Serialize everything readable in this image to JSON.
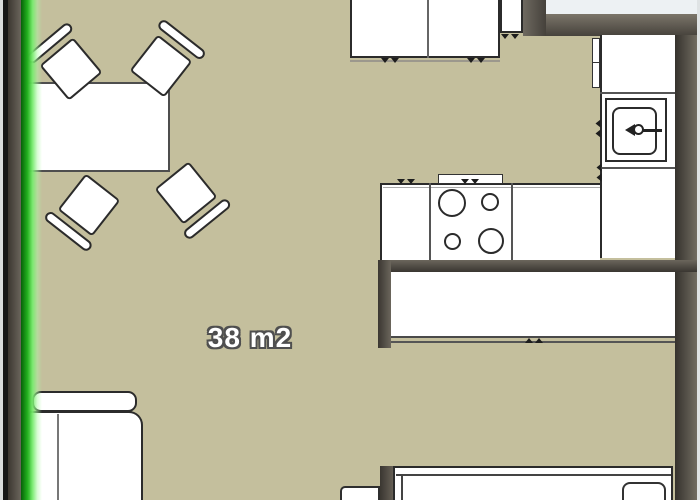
{
  "room": {
    "area_label": "38 m2"
  },
  "colors": {
    "floor": "#c4bf9d",
    "wall_dark": "#3a3631",
    "wall_light": "#7b7569",
    "exterior": "#edf1f3",
    "furniture_fill": "#ffffff",
    "furniture_outline": "#2b2b2b",
    "highlight_green": "#3ecf38",
    "label_text": "#ffffff",
    "label_outline": "#4f4f4f"
  },
  "furniture_items": [
    "dining-table",
    "dining-chair-top-left",
    "dining-chair-top-right",
    "dining-chair-bottom-left",
    "dining-chair-bottom-right",
    "top-cabinet-run",
    "tall-cabinet",
    "sink-counter",
    "sink",
    "stove-counter",
    "cooktop-four-burners",
    "radiator-panel",
    "wardrobe",
    "bed",
    "pillow",
    "sofa",
    "side-furniture"
  ]
}
